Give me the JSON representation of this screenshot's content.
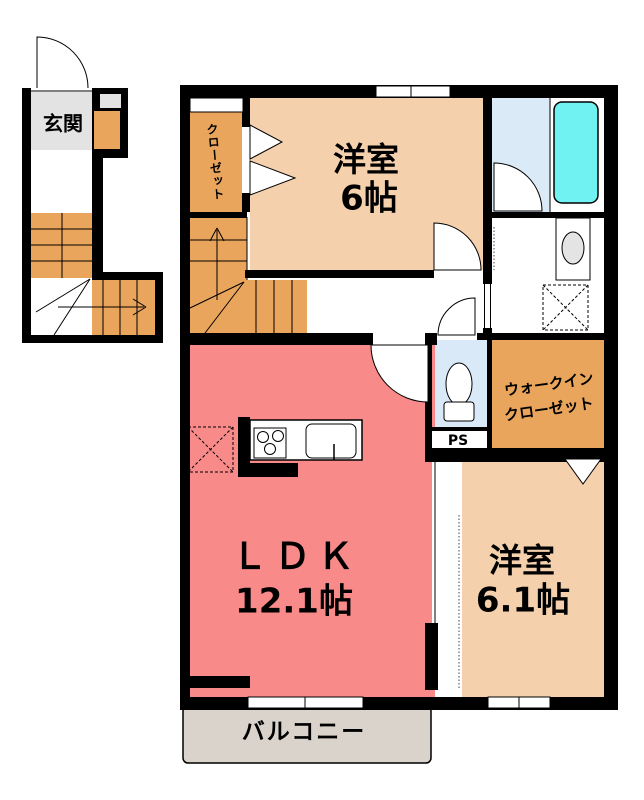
{
  "title": "2F apartment floor plan",
  "colors": {
    "wall": "#000000",
    "bedroom": "#F4D0AC",
    "ldk": "#F98A8A",
    "stairs": "#EAA55C",
    "bath_floor": "#DBEAF7",
    "toilet_floor": "#D9E9F8",
    "bathtub": "#70F2F2",
    "balcony": "#D9D3CB",
    "genkan": "#E3E3E3"
  },
  "rooms": {
    "genkan": {
      "label": "玄関"
    },
    "closet": {
      "label": "クローゼット"
    },
    "bedroom1": {
      "name": "洋室",
      "size": "6帖"
    },
    "ldk": {
      "name": "ＬＤＫ",
      "size": "12.1帖"
    },
    "bedroom2": {
      "name": "洋室",
      "size": "6.1帖"
    },
    "wic": {
      "line1": "ウォークイン",
      "line2": "クローゼット"
    },
    "ps": {
      "label": "PS"
    },
    "balcony": {
      "label": "バルコニー"
    }
  },
  "fixtures": [
    "bathtub",
    "toilet",
    "wash-basin",
    "washing-machine-space",
    "refrigerator-space",
    "gas-stove",
    "kitchen-sink",
    "staircase",
    "entrance-door",
    "door-swing",
    "folding-door",
    "window"
  ]
}
